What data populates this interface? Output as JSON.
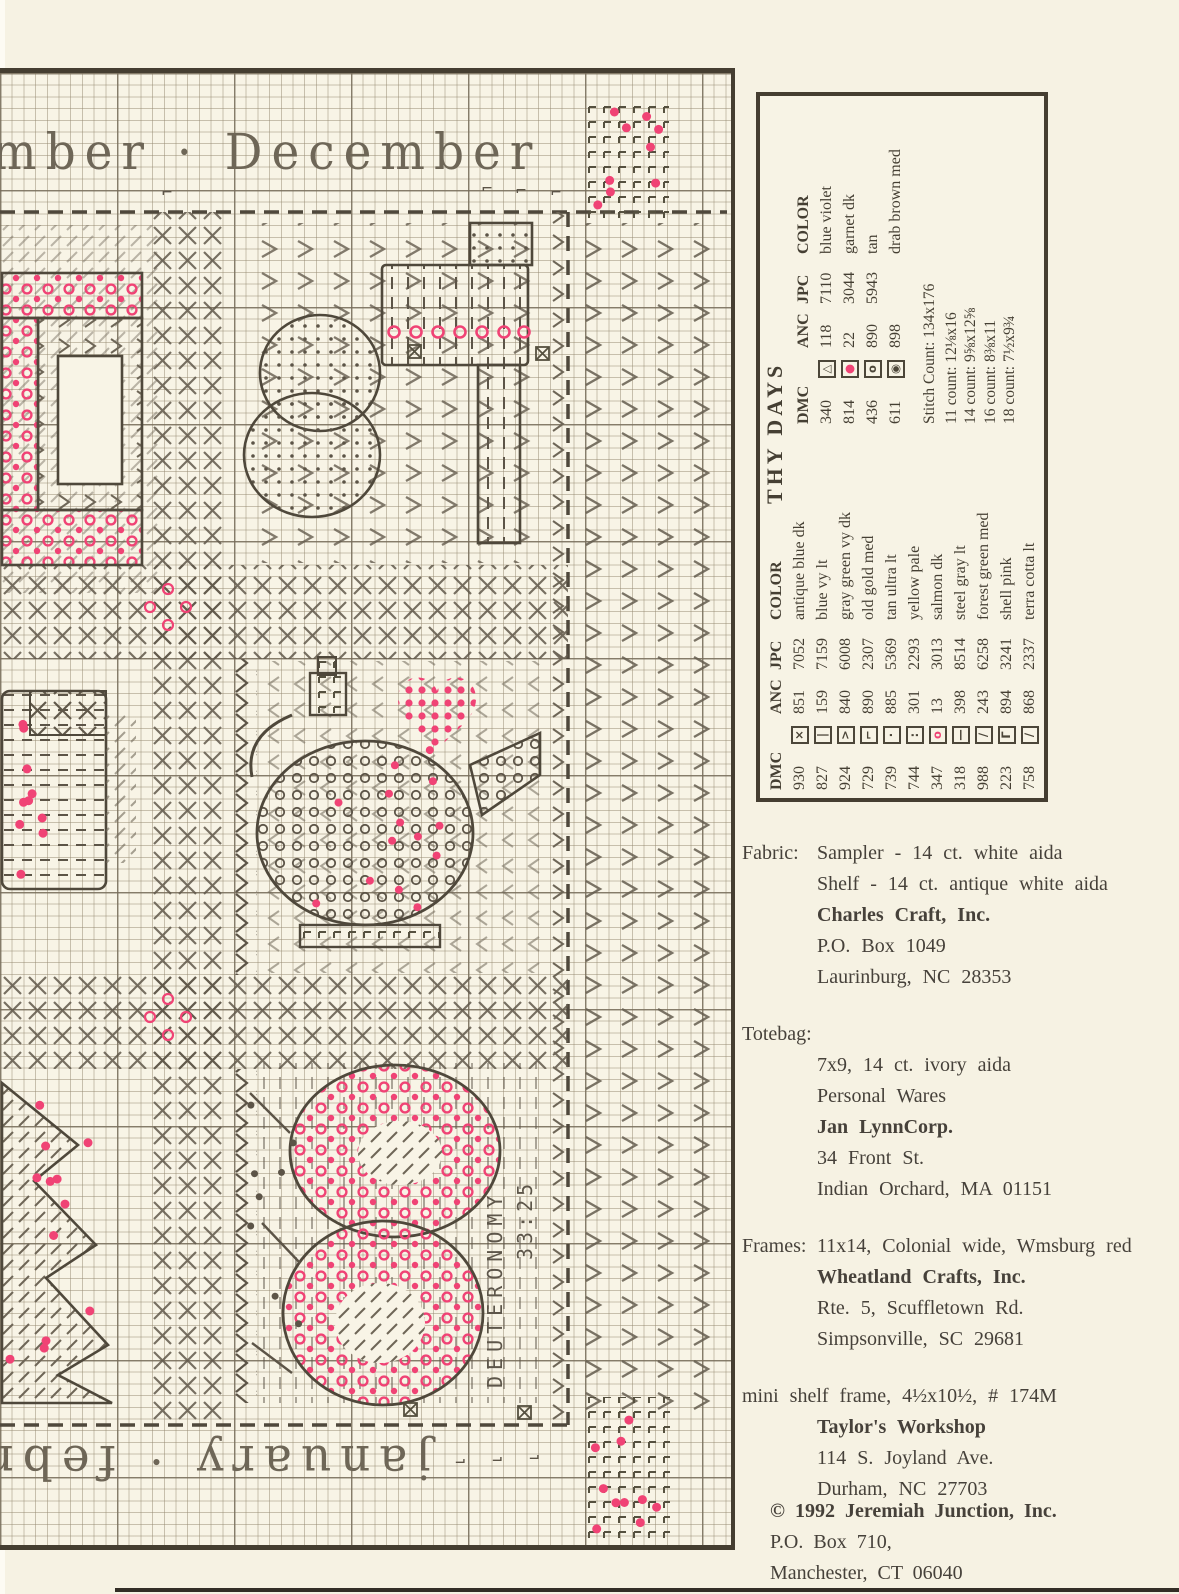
{
  "chart": {
    "top_band_label": "mber · December",
    "bottom_band_label": "january · february",
    "verse_line1": "DEUTERONOMY",
    "verse_line2": "33:25",
    "corner_mark": "⌐"
  },
  "legend": {
    "title": "THY DAYS",
    "col_dmc": "DMC",
    "col_anc": "ANC",
    "col_jpc": "JPC",
    "col_color": "COLOR",
    "rows": [
      {
        "dmc": "930",
        "sym": "×",
        "anc": "851",
        "jpc": "7052",
        "color": "antique blue dk",
        "pink": false
      },
      {
        "dmc": "827",
        "sym": "|",
        "anc": "159",
        "jpc": "7159",
        "color": "blue vy lt",
        "pink": false
      },
      {
        "dmc": "924",
        "sym": ">",
        "anc": "840",
        "jpc": "6008",
        "color": "gray green vy dk",
        "pink": false
      },
      {
        "dmc": "729",
        "sym": "⌐",
        "anc": "890",
        "jpc": "2307",
        "color": "old gold med",
        "pink": false
      },
      {
        "dmc": "739",
        "sym": "·",
        "anc": "885",
        "jpc": "5369",
        "color": "tan ultra lt",
        "pink": false
      },
      {
        "dmc": "744",
        "sym": ":",
        "anc": "301",
        "jpc": "2293",
        "color": "yellow pale",
        "pink": false
      },
      {
        "dmc": "347",
        "sym": "o",
        "anc": "13",
        "jpc": "3013",
        "color": "salmon dk",
        "pink": true
      },
      {
        "dmc": "318",
        "sym": "—",
        "anc": "398",
        "jpc": "8514",
        "color": "steel gray lt",
        "pink": false
      },
      {
        "dmc": "988",
        "sym": "/",
        "anc": "243",
        "jpc": "6258",
        "color": "forest green med",
        "pink": false
      },
      {
        "dmc": "223",
        "sym": "Γ",
        "anc": "894",
        "jpc": "3241",
        "color": "shell pink",
        "pink": false
      },
      {
        "dmc": "758",
        "sym": "/",
        "anc": "868",
        "jpc": "2337",
        "color": "terra cotta lt",
        "pink": false
      }
    ],
    "rows2": [
      {
        "dmc": "340",
        "sym": "△",
        "anc": "118",
        "jpc": "7110",
        "color": "blue violet",
        "pink": false
      },
      {
        "dmc": "814",
        "sym": "●",
        "anc": "22",
        "jpc": "3044",
        "color": "garnet dk",
        "pink": true
      },
      {
        "dmc": "436",
        "sym": "o",
        "anc": "890",
        "jpc": "5943",
        "color": "tan",
        "pink": false
      },
      {
        "dmc": "611",
        "sym": "◉",
        "anc": "898",
        "jpc": "",
        "color": "drab brown med",
        "pink": false
      }
    ],
    "stitch_count": "Stitch Count: 134x176",
    "sizes": [
      "11 count: 12⅛x16",
      "14 count: 9⅝x12⅝",
      "16 count: 8⅜x11",
      "18 count: 7½x9¾"
    ]
  },
  "supplies": {
    "fabric_label": "Fabric:",
    "fabric_line1": "Sampler - 14 ct. white aida",
    "fabric_line2": "Shelf - 14 ct. antique white aida",
    "fabric_company": "Charles Craft, Inc.",
    "fabric_addr1": "P.O. Box 1049",
    "fabric_addr2": "Laurinburg, NC 28353",
    "totebag_label": "Totebag:",
    "totebag_line1": "7x9, 14 ct. ivory aida",
    "totebag_line2": "Personal Wares",
    "totebag_company": "Jan LynnCorp.",
    "totebag_addr1": "34 Front St.",
    "totebag_addr2": "Indian Orchard, MA 01151",
    "frames_label": "Frames:",
    "frames_line1": "11x14, Colonial wide, Wmsburg red",
    "frames_company": "Wheatland Crafts, Inc.",
    "frames_addr1": "Rte. 5, Scuffletown Rd.",
    "frames_addr2": "Simpsonville, SC 29681",
    "shelf_line1": "mini shelf frame, 4½x10½, # 174M",
    "shelf_company": "Taylor's Workshop",
    "shelf_addr1": "114 S. Joyland Ave.",
    "shelf_addr2": "Durham, NC 27703"
  },
  "copyright": {
    "line1": "© 1992 Jeremiah Junction, Inc.",
    "line2": "P.O. Box 710,",
    "line3": "Manchester, CT 06040"
  }
}
